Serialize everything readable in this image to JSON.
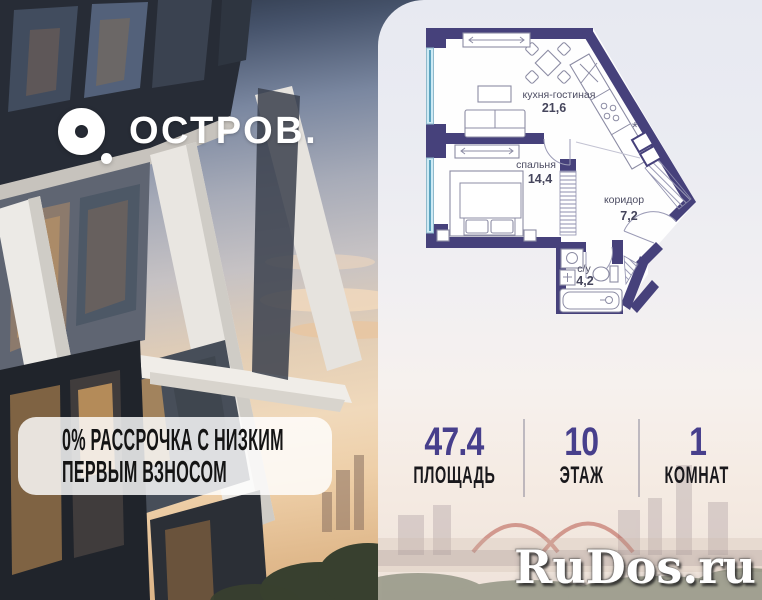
{
  "brand": {
    "name": "ОСТРОВ."
  },
  "promo": {
    "line1": "0% РАССРОЧКА С НИЗКИМ",
    "line2": "ПЕРВЫМ ВЗНОСОМ"
  },
  "floor_plan": {
    "rooms": [
      {
        "name": "кухня-гостиная",
        "area": "21,6"
      },
      {
        "name": "спальня",
        "area": "14,4"
      },
      {
        "name": "коридор",
        "area": "7,2"
      },
      {
        "name": "с/у",
        "area": "4,2"
      }
    ]
  },
  "stats": {
    "items": [
      {
        "value": "47.4",
        "label": "ПЛОЩАДЬ"
      },
      {
        "value": "10",
        "label": "ЭТАЖ"
      },
      {
        "value": "1",
        "label": "КОМНАТ"
      }
    ]
  },
  "watermark": "RuDos.ru",
  "colors": {
    "wall": "#46417b",
    "window": "#a6dcec",
    "stat_number": "#473f8c",
    "promo_text": "#141414"
  }
}
